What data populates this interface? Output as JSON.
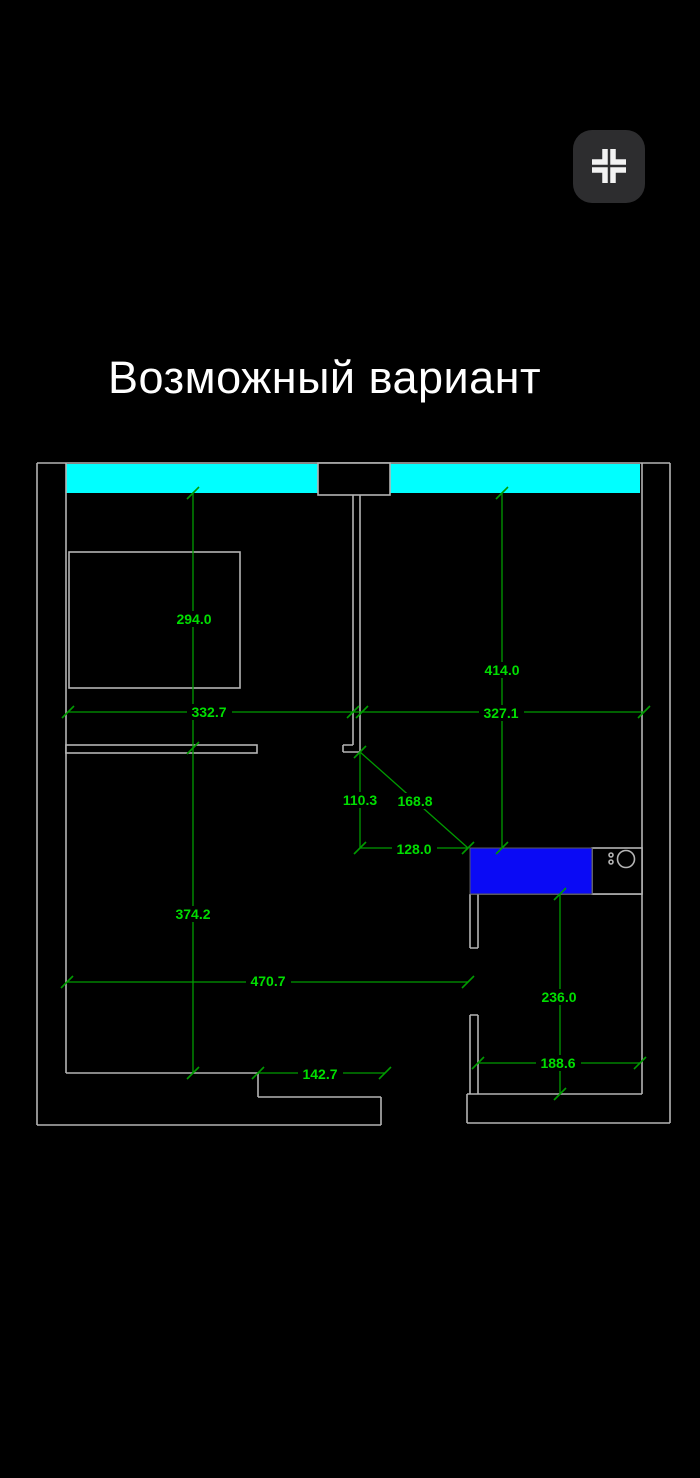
{
  "title": "Возможный вариант",
  "header": {
    "collapse_button": {
      "icon": "compress-icon"
    }
  },
  "plan": {
    "colors": {
      "wall": "#b4b4b4",
      "window_fill": "#00ffff",
      "fixture_fill": "#0a0af5",
      "dim_line": "#009b00",
      "dim_text": "#00de00"
    },
    "dimensions": [
      {
        "value": "294.0"
      },
      {
        "value": "414.0"
      },
      {
        "value": "332.7"
      },
      {
        "value": "327.1"
      },
      {
        "value": "110.3"
      },
      {
        "value": "168.8"
      },
      {
        "value": "128.0"
      },
      {
        "value": "374.2"
      },
      {
        "value": "470.7"
      },
      {
        "value": "236.0"
      },
      {
        "value": "188.6"
      },
      {
        "value": "142.7"
      }
    ]
  }
}
